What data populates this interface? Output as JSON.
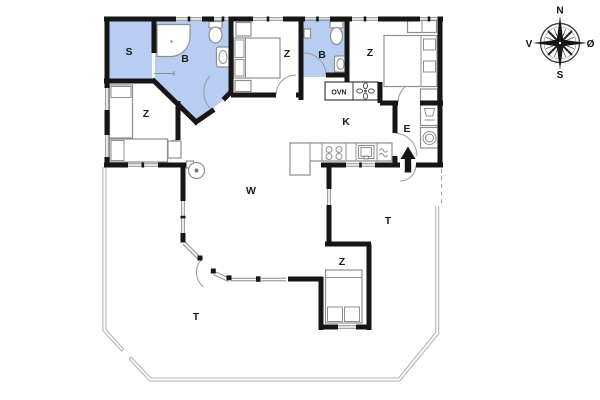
{
  "plan": {
    "rooms": {
      "sauna": {
        "label": "S"
      },
      "bathroom1": {
        "label": "B"
      },
      "bathroom2": {
        "label": "B"
      },
      "bedroom_left": {
        "label": "Z"
      },
      "bedroom_mid": {
        "label": "Z"
      },
      "bedroom_right": {
        "label": "Z"
      },
      "bedroom_south": {
        "label": "Z"
      },
      "kitchen": {
        "label": "K"
      },
      "entrance": {
        "label": "E"
      },
      "living_room": {
        "label": "W"
      },
      "terrace_east": {
        "label": "T"
      },
      "terrace_south": {
        "label": "T"
      }
    },
    "fixtures": {
      "oven_label": "OVN"
    },
    "compass": {
      "north": "N",
      "south": "S",
      "west": "V",
      "east": "Ø"
    }
  },
  "colors": {
    "wall": "#161616",
    "wet_room_fill": "#b8cdf2",
    "terrace_line": "#b5b5b5",
    "furniture_line": "#8f8f8f"
  }
}
